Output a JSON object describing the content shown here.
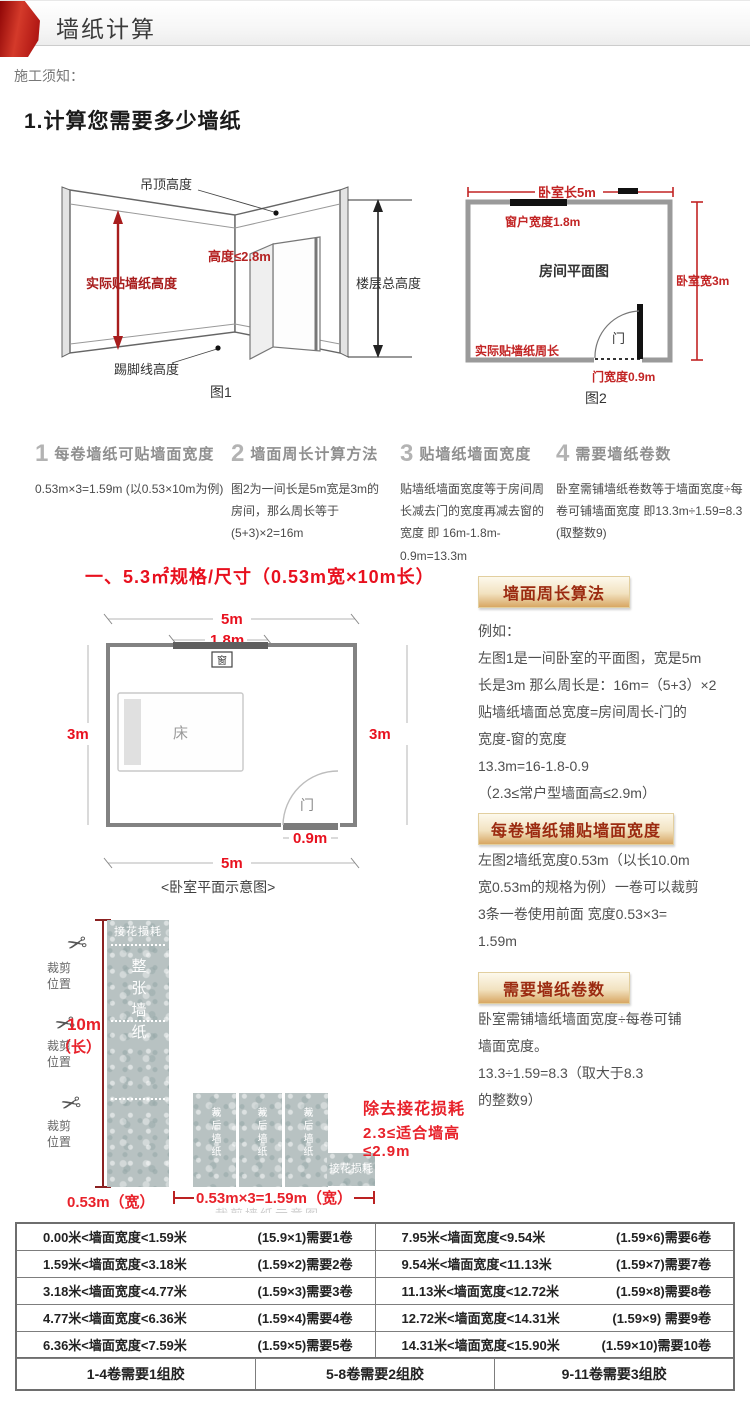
{
  "header": {
    "title": "墙纸计算"
  },
  "notice": "施工须知：",
  "section_title": "1.计算您需要多少墙纸",
  "figure1": {
    "ceiling_label": "吊顶高度",
    "height_label": "高度≤2.8m",
    "paste_height_label": "实际贴墙纸高度",
    "floor_height_label": "楼层总高度",
    "baseboard_label": "踢脚线高度",
    "caption": "图1"
  },
  "figure2": {
    "length_label": "卧室长5m",
    "window_label": "窗户宽度1.8m",
    "plan_label": "房间平面图",
    "width_label": "卧室宽3m",
    "perimeter_label": "实际贴墙纸周长",
    "door_label": "门",
    "door_width_label": "门宽度0.9m",
    "caption": "图2"
  },
  "steps": [
    {
      "num": "1",
      "title": "每卷墙纸可贴墙面宽度",
      "body": "0.53m×3=1.59m (以0.53×10m为例)"
    },
    {
      "num": "2",
      "title": "墙面周长计算方法",
      "body": "图2为一间长是5m宽是3m的房间，那么周长等于 (5+3)×2=16m"
    },
    {
      "num": "3",
      "title": "贴墙纸墙面宽度",
      "body": "贴墙纸墙面宽度等于房间周长减去门的宽度再减去窗的宽度 即 16m-1.8m-0.9m=13.3m"
    },
    {
      "num": "4",
      "title": "需要墙纸卷数",
      "body": "卧室需铺墙纸卷数等于墙面宽度÷每卷可铺墙面宽度 即13.3m÷1.59=8.3 (取整数9)"
    }
  ],
  "spec_title": "一、5.3㎡规格/尺寸（0.53m宽×10m长）",
  "plan": {
    "top_5m": "5m",
    "win_18": "1.8m",
    "window_char": "窗",
    "left_3m": "3m",
    "right_3m": "3m",
    "bed": "床",
    "door": "门",
    "door_09": "0.9m",
    "bottom_5m": "5m",
    "caption": "<卧室平面示意图>"
  },
  "sections": [
    {
      "badge": "墙面周长算法",
      "l0": "例如：",
      "l1": "左图1是一间卧室的平面图，宽是5m",
      "l2": "长是3m 那么周长是：16m=（5+3）×2",
      "l3": "贴墙纸墙面总宽度=房间周长-门的",
      "l4": "宽度-窗的宽度",
      "l5": "13.3m=16-1.8-0.9",
      "l6": "（2.3≤常户型墙面高≤2.9m）"
    },
    {
      "badge": "每卷墙纸铺贴墙面宽度",
      "l0": "左图2墙纸宽度0.53m（以长10.0m",
      "l1": "宽0.53m的规格为例）一卷可以裁剪",
      "l2": "3条一卷使用前面 宽度0.53×3=",
      "l3": "1.59m"
    },
    {
      "badge": "需要墙纸卷数",
      "l0": "卧室需铺墙纸墙面宽度÷每卷可铺",
      "l1": "墙面宽度。",
      "l2": "13.3÷1.59=8.3（取大于8.3",
      "l3": "的整数9）"
    }
  ],
  "cutting": {
    "cut_pos": "裁剪位置",
    "len_10m": "10m",
    "len_unit": "（长）",
    "waste_top": "接花损耗",
    "full_roll": "整张墙纸",
    "width_053": "0.53m（宽）",
    "strip_label": "裁后墙纸",
    "waste_small": "接花损耗",
    "note1": "除去接花损耗",
    "note2": "2.3≤适合墙高≤2.9m",
    "bottom_dim": "0.53m×3=1.59m（宽）",
    "faint_caption": "栽剪墙纸示意图"
  },
  "table": {
    "rows_left": [
      {
        "range": "0.00米<墙面宽度<1.59米",
        "formula": "(15.9×1)需要1卷"
      },
      {
        "range": "1.59米<墙面宽度<3.18米",
        "formula": "(1.59×2)需要2卷"
      },
      {
        "range": "3.18米<墙面宽度<4.77米",
        "formula": "(1.59×3)需要3卷"
      },
      {
        "range": "4.77米<墙面宽度<6.36米",
        "formula": "(1.59×4)需要4卷"
      },
      {
        "range": "6.36米<墙面宽度<7.59米",
        "formula": "(1.59×5)需要5卷"
      }
    ],
    "rows_right": [
      {
        "range": "7.95米<墙面宽度<9.54米",
        "formula": "(1.59×6)需要6卷"
      },
      {
        "range": "9.54米<墙面宽度<11.13米",
        "formula": "(1.59×7)需要7卷"
      },
      {
        "range": "11.13米<墙面宽度<12.72米",
        "formula": "(1.59×8)需要8卷"
      },
      {
        "range": "12.72米<墙面宽度<14.31米",
        "formula": "(1.59×9) 需要9卷"
      },
      {
        "range": "14.31米<墙面宽度<15.90米",
        "formula": "(1.59×10)需要10卷"
      }
    ],
    "footer": [
      "1-4卷需要1组胶",
      "5-8卷需要2组胶",
      "9-11卷需要3组胶"
    ]
  },
  "colors": {
    "ribbon_red": "#b00b0b",
    "bright_red": "#e8101e",
    "crimson": "#a81d1d",
    "badge_text": "#9b2a10",
    "wallpaper_gray": "#b8c2c2",
    "table_border": "#7d7d7d"
  }
}
